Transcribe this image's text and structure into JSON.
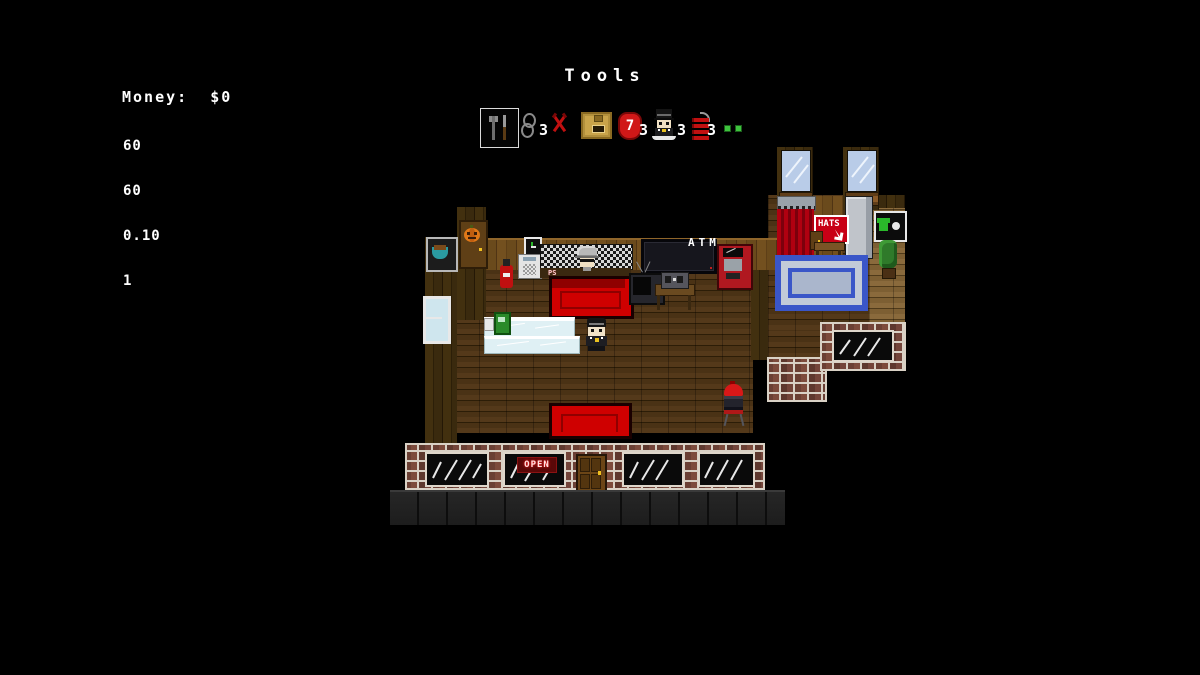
{
  "hud": {
    "money_label": "Money:  $0",
    "stats": [
      "60",
      "60",
      "0.10",
      "1"
    ],
    "title": "Tools"
  },
  "hotbar": {
    "slots": [
      {
        "name": "tools",
        "selected": true
      },
      {
        "name": "handcuffs",
        "count": "3"
      },
      {
        "name": "scissors"
      },
      {
        "name": "crate"
      },
      {
        "name": "seven-badge",
        "label": "7",
        "count": "3"
      },
      {
        "name": "figure",
        "count": "3"
      },
      {
        "name": "dynamite",
        "count": "3"
      },
      {
        "name": "green-dots"
      }
    ]
  },
  "scene": {
    "atm_label": "ATM",
    "hats_sign": "HATS",
    "open_sign": "OPEN",
    "counter_tag": "PS"
  },
  "colors": {
    "background": "#000000",
    "couch_red": "#cf0000",
    "rug_blue": "#3a56c8",
    "open_red": "#ff2020",
    "hats_red": "#c80016",
    "window_blue": "#b9cce8",
    "green_dot": "#3ec43e",
    "wood_light": "#73501f",
    "wood_dark": "#3a2a0e",
    "brick_mortar": "#d9d1c5"
  }
}
